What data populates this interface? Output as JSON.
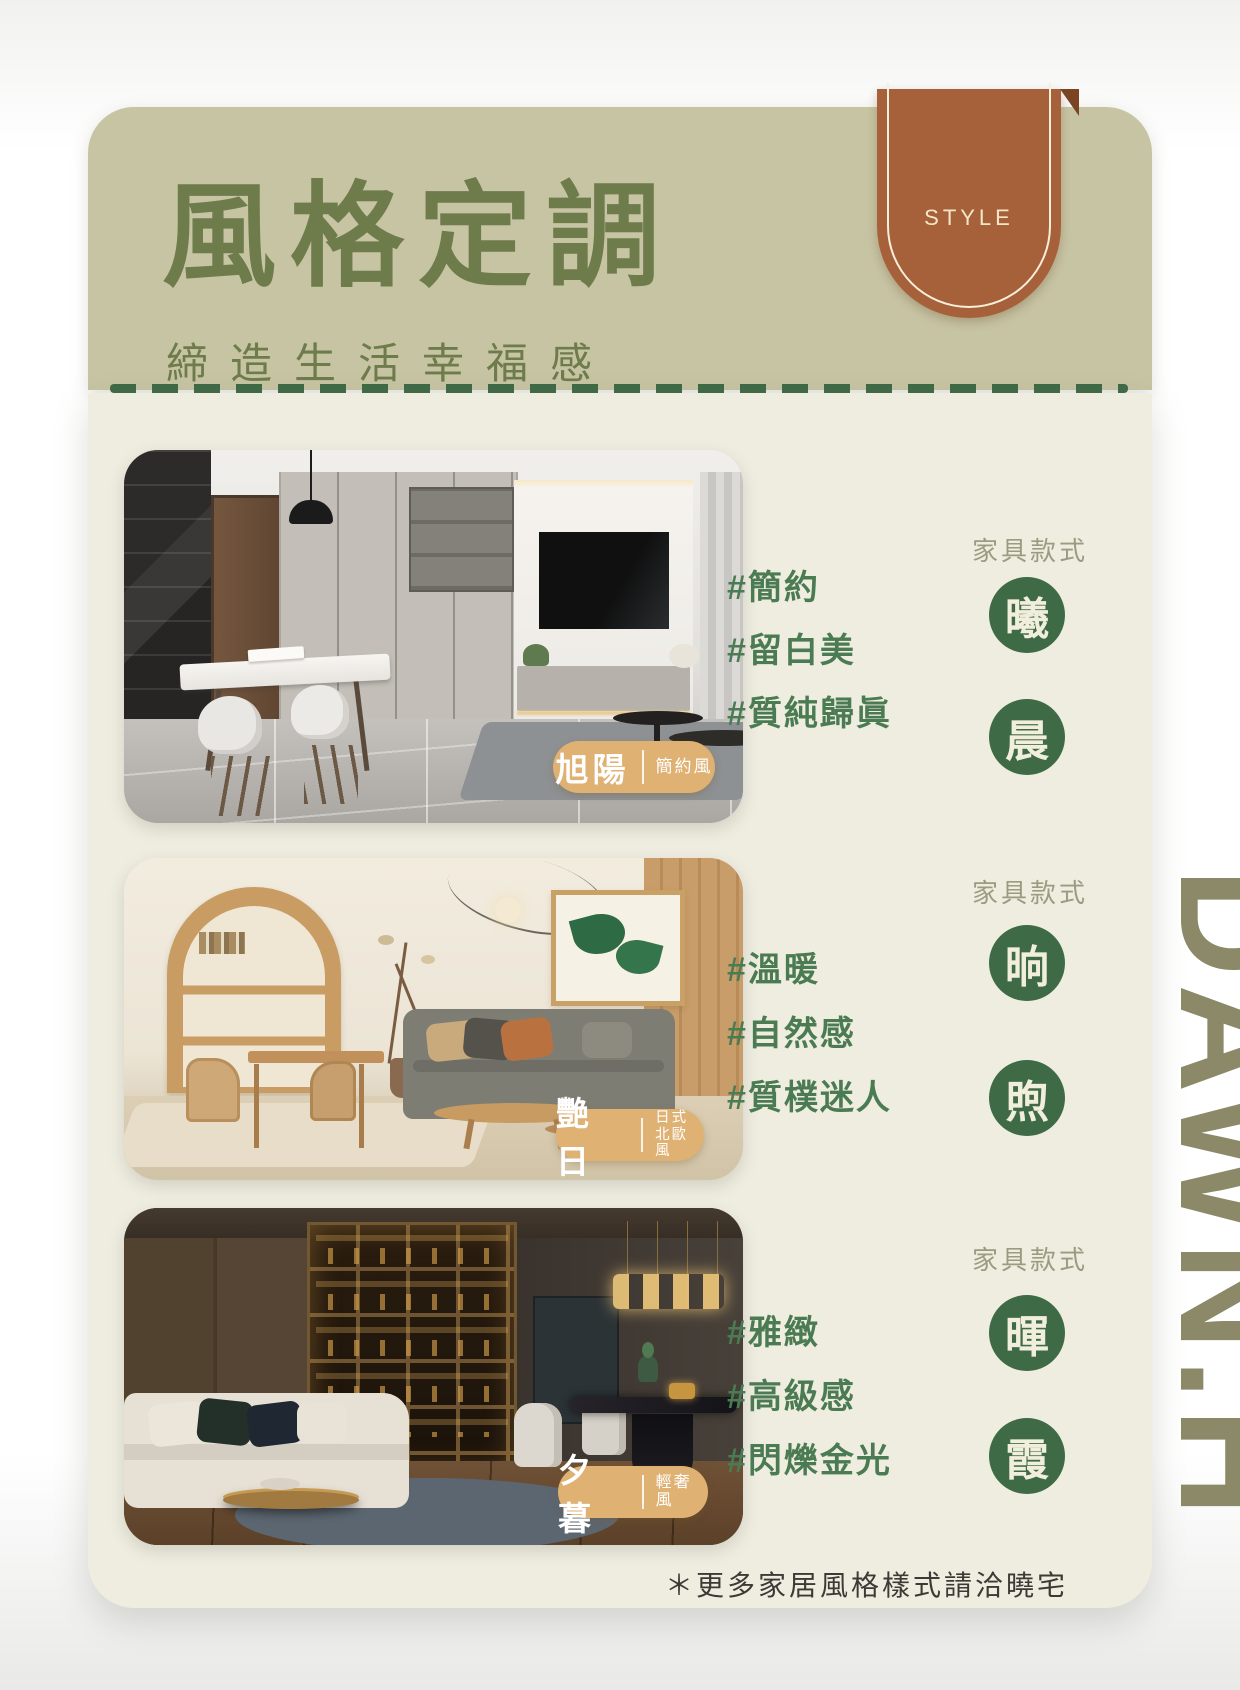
{
  "header": {
    "title": "風格定調",
    "subtitle": "締造生活幸福感",
    "ribbon_label": "STYLE"
  },
  "sections": [
    {
      "style_name": "旭陽",
      "style_type": "簡約風",
      "hashtags": [
        "#簡約",
        "#留白美",
        "#質純歸眞"
      ],
      "furniture_label": "家具款式",
      "furniture_items": [
        "曦",
        "晨"
      ]
    },
    {
      "style_name": "艷日",
      "style_type_line1": "日式",
      "style_type_line2": "北歐風",
      "hashtags": [
        "#溫暖",
        "#自然感",
        "#質樸迷人"
      ],
      "furniture_label": "家具款式",
      "furniture_items": [
        "晌",
        "煦"
      ]
    },
    {
      "style_name": "夕暮",
      "style_type": "輕奢風",
      "hashtags": [
        "#雅緻",
        "#高級感",
        "#閃爍金光"
      ],
      "furniture_label": "家具款式",
      "furniture_items": [
        "暉",
        "霞"
      ]
    }
  ],
  "footer": {
    "note": "＊更多家居風格樣式請洽曉宅"
  },
  "watermark": "DAWN.H",
  "colors": {
    "header_bg": "#c7c4a3",
    "title_green": "#6e7c4c",
    "ribbon_brown": "#a6613a",
    "ribbon_fold": "#7b4423",
    "body_cream": "#efede0",
    "dash_green": "#3f6a47",
    "hashtag_green": "#4b7b52",
    "circle_green": "#3e6b45",
    "badge_tan": "#dfb173",
    "watermark_olive": "#8b8968"
  }
}
